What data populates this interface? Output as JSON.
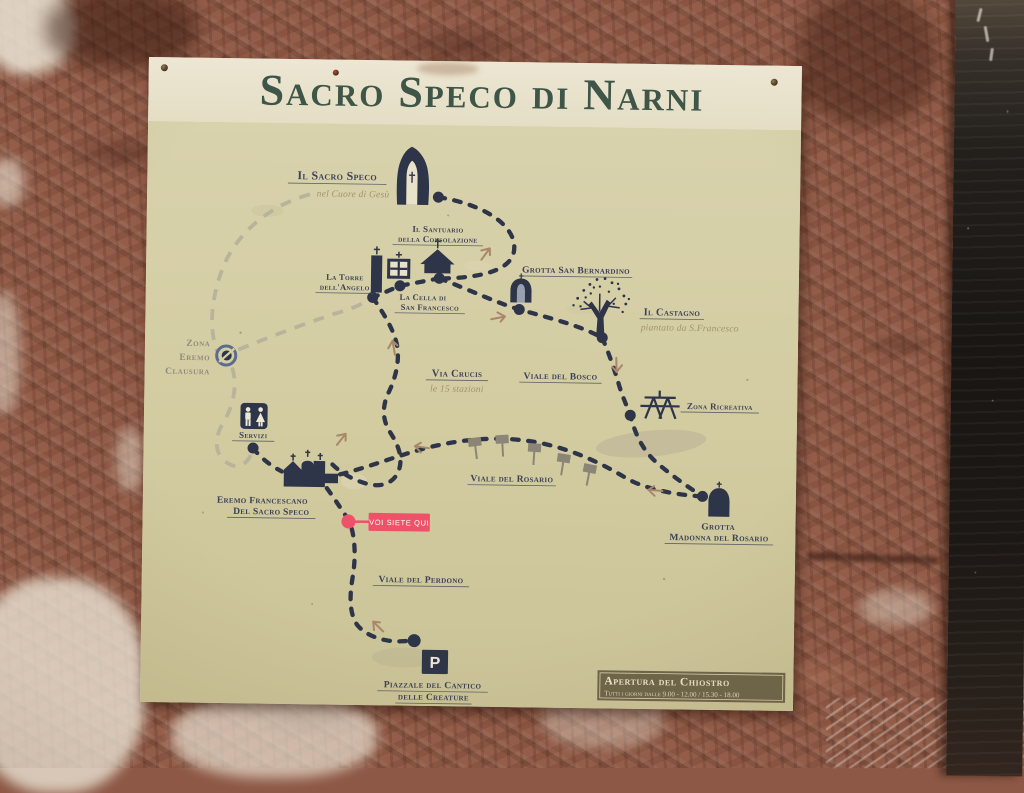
{
  "sign": {
    "title": "Sacro Speco di Narni",
    "map": {
      "labels": {
        "sacro_speco": {
          "line1": "Il Sacro Speco",
          "sub": "nel Cuore di Gesù"
        },
        "santuario": {
          "line1": "Il Santuario",
          "line2": "della Consolazione"
        },
        "torre": {
          "line1": "La Torre",
          "line2": "dell'Angelo"
        },
        "cella": {
          "line1": "La Cella di",
          "line2": "San Francesco"
        },
        "bernardino": {
          "line1": "Grotta San Bernardino"
        },
        "castagno": {
          "line1": "Il Castagno",
          "sub": "piantato da S.Francesco"
        },
        "zona_eremo": {
          "line1": "Zona",
          "line2": "Eremo",
          "line3": "Clausura"
        },
        "via_crucis": {
          "line1": "Via Crucis",
          "sub": "le 15 stazioni"
        },
        "viale_bosco": {
          "line1": "Viale del Bosco"
        },
        "zona_ricreativa": {
          "line1": "Zona Ricreativa"
        },
        "servizi": {
          "line1": "Servizi"
        },
        "viale_rosario": {
          "line1": "Viale del Rosario"
        },
        "eremo": {
          "line1": "Eremo Francescano",
          "line2": "Del Sacro Speco"
        },
        "grotta_madonna": {
          "line1": "Grotta",
          "line2": "Madonna del Rosario"
        },
        "viale_perdono": {
          "line1": "Viale del Perdono"
        },
        "piazzale": {
          "line1": "Piazzale del Cantico",
          "line2": "delle Creature"
        },
        "parking": "P"
      },
      "you_are_here": "VOI SIETE QUI"
    },
    "info_box": {
      "title": "Apertura del Chiostro",
      "hours": "Tutti i giorni dalle 9.00 - 12.00 / 15.30 - 18.00"
    }
  },
  "colors": {
    "trail": "#2e3548",
    "trail_closed_area": "#b9b39c",
    "you_are_here_pink": "#ef5268",
    "title_green": "#3e5548",
    "sign_cream": "#e7e0c9",
    "map_khaki": "#d3cca1",
    "info_box_olive": "#6c6349",
    "arrow_tan": "#a8876b"
  }
}
